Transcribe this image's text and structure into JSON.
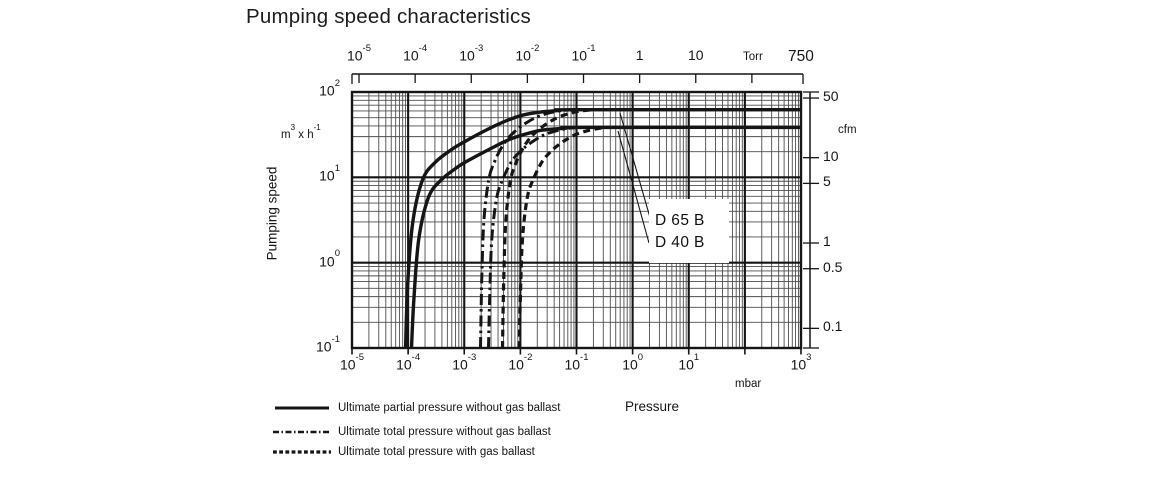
{
  "title": "Pumping speed characteristics",
  "ink_color": "#151515",
  "grid_minor_color": "#4d4d4d",
  "axes": {
    "top": {
      "unit": "Torr",
      "tick_labels": [
        "10{-5}",
        "10{-4}",
        "10{-3}",
        "10{-2}",
        "10{-1}",
        "1",
        "10"
      ],
      "tick_values_torr": [
        1e-05,
        0.0001,
        0.001,
        0.01,
        0.1,
        1,
        10
      ],
      "unlabeled_tick_torr": 100,
      "end_label": "750",
      "end_value_torr": 750
    },
    "bottom": {
      "unit": "mbar",
      "axis_title": "Pressure",
      "tick_labels": [
        "10{-5}",
        "10{-4}",
        "10{-3}",
        "10{-2}",
        "10{-1}",
        "10{0}",
        "10{1}",
        "10{3}"
      ],
      "tick_values_mbar": [
        1e-05,
        0.0001,
        0.001,
        0.01,
        0.1,
        1,
        10,
        1000
      ],
      "range_mbar": [
        1e-05,
        1000
      ]
    },
    "left": {
      "unit": "m{3} x h{-1}",
      "axis_title": "Pumping speed",
      "tick_labels": [
        "10{2}",
        "10{1}",
        "10{0}",
        "10{-1}"
      ],
      "tick_values_m3h": [
        100,
        10,
        1,
        0.1
      ],
      "range_m3h": [
        0.1,
        100
      ]
    },
    "right": {
      "unit": "cfm",
      "tick_labels": [
        "50",
        "10",
        "5",
        "1",
        "0.5",
        "0.1"
      ],
      "tick_values_cfm": [
        50,
        10,
        5,
        1,
        0.5,
        0.1
      ],
      "m3h_per_cfm": 1.699
    }
  },
  "chart_data": {
    "type": "line",
    "title": "Pumping speed characteristics",
    "x_label": "Pressure",
    "x_unit": "mbar",
    "x_scale": "log",
    "x_range": [
      1e-05,
      1000
    ],
    "y_label": "Pumping speed",
    "y_unit": "m3 x h-1",
    "y_scale": "log",
    "y_range": [
      0.1,
      100
    ],
    "grid": {
      "major": "decades",
      "minor_steps": [
        2,
        3,
        4,
        5,
        6,
        7,
        8,
        9
      ]
    },
    "series": [
      {
        "pump": "D 65 B",
        "style": "solid",
        "meaning": "Ultimate partial pressure without gas ballast",
        "max_speed_m3h": 62,
        "points": [
          [
            9e-05,
            0.1
          ],
          [
            9.9e-05,
            0.62
          ],
          [
            0.000122,
            3.1
          ],
          [
            0.00018,
            9.3
          ],
          [
            0.0003,
            14.9
          ],
          [
            0.00059,
            21.1
          ],
          [
            0.001,
            26
          ],
          [
            0.0025,
            36
          ],
          [
            0.005,
            44.6
          ],
          [
            0.01,
            52.7
          ],
          [
            0.02,
            57.7
          ],
          [
            0.05,
            60.8
          ],
          [
            0.1,
            62
          ],
          [
            1050,
            62
          ]
        ]
      },
      {
        "pump": "D 40 B",
        "style": "solid",
        "meaning": "Ultimate partial pressure without gas ballast",
        "max_speed_m3h": 38.5,
        "points": [
          [
            0.000115,
            0.1
          ],
          [
            0.000127,
            0.39
          ],
          [
            0.000155,
            1.9
          ],
          [
            0.00023,
            5.8
          ],
          [
            0.00038,
            9.2
          ],
          [
            0.00075,
            13.1
          ],
          [
            0.00127,
            16.2
          ],
          [
            0.0032,
            22.3
          ],
          [
            0.0063,
            27.7
          ],
          [
            0.0127,
            32.3
          ],
          [
            0.025,
            35.8
          ],
          [
            0.063,
            37.7
          ],
          [
            0.13,
            38.5
          ],
          [
            1050,
            38.5
          ]
        ]
      },
      {
        "pump": "D 65 B",
        "style": "dashdot",
        "meaning": "Ultimate total pressure without gas ballast",
        "max_speed_m3h": 62,
        "points": [
          [
            0.00195,
            0.1
          ],
          [
            0.00205,
            0.62
          ],
          [
            0.00224,
            3.1
          ],
          [
            0.00273,
            9.3
          ],
          [
            0.0035,
            15.5
          ],
          [
            0.0051,
            24.8
          ],
          [
            0.0078,
            34.1
          ],
          [
            0.0127,
            43.4
          ],
          [
            0.0195,
            50.8
          ],
          [
            0.031,
            56.4
          ],
          [
            0.049,
            60.1
          ],
          [
            0.085,
            62
          ]
        ]
      },
      {
        "pump": "D 40 B",
        "style": "dashdot",
        "meaning": "Ultimate total pressure without gas ballast",
        "max_speed_m3h": 38.5,
        "points": [
          [
            0.0027,
            0.1
          ],
          [
            0.00284,
            0.39
          ],
          [
            0.0031,
            1.9
          ],
          [
            0.0038,
            5.8
          ],
          [
            0.0049,
            9.6
          ],
          [
            0.007,
            15.4
          ],
          [
            0.0108,
            21.2
          ],
          [
            0.0176,
            27
          ],
          [
            0.027,
            31.6
          ],
          [
            0.043,
            35
          ],
          [
            0.068,
            37.3
          ],
          [
            0.11,
            38.5
          ]
        ]
      },
      {
        "pump": "D 65 B",
        "style": "dashed",
        "meaning": "Ultimate total pressure with gas ballast",
        "max_speed_m3h": 62,
        "points": [
          [
            0.0048,
            0.1
          ],
          [
            0.00505,
            0.62
          ],
          [
            0.0055,
            3.1
          ],
          [
            0.0067,
            9.3
          ],
          [
            0.0086,
            15.5
          ],
          [
            0.0125,
            24.8
          ],
          [
            0.019,
            34.1
          ],
          [
            0.031,
            43.4
          ],
          [
            0.048,
            50.8
          ],
          [
            0.077,
            56.4
          ],
          [
            0.12,
            60.1
          ],
          [
            0.2,
            62
          ]
        ]
      },
      {
        "pump": "D 40 B",
        "style": "dashed",
        "meaning": "Ultimate total pressure with gas ballast",
        "max_speed_m3h": 38.5,
        "points": [
          [
            0.0095,
            0.1
          ],
          [
            0.01,
            0.39
          ],
          [
            0.0109,
            1.9
          ],
          [
            0.0133,
            5.8
          ],
          [
            0.0171,
            9.6
          ],
          [
            0.0247,
            15.4
          ],
          [
            0.038,
            21.2
          ],
          [
            0.062,
            27
          ],
          [
            0.095,
            31.6
          ],
          [
            0.152,
            35
          ],
          [
            0.24,
            37.3
          ],
          [
            0.35,
            38.5
          ]
        ]
      }
    ]
  },
  "curve_labels": [
    {
      "label": "D 65 B"
    },
    {
      "label": "D 40 B"
    }
  ],
  "legend": [
    {
      "style": "solid",
      "label": "Ultimate partial pressure without gas ballast"
    },
    {
      "style": "dashdot",
      "label": "Ultimate total pressure without gas ballast"
    },
    {
      "style": "dashed",
      "label": "Ultimate total pressure with gas ballast"
    }
  ]
}
